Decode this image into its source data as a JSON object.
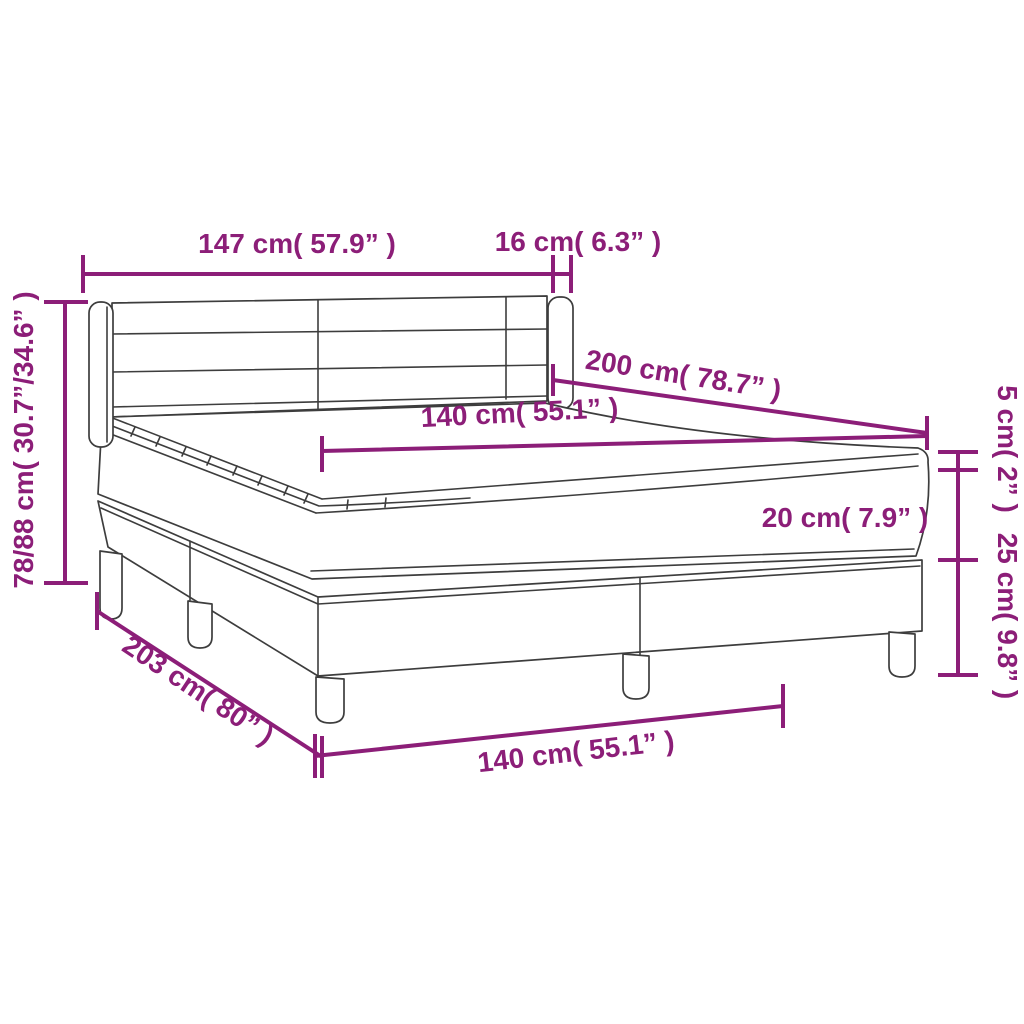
{
  "meta": {
    "description": "Dimension diagram of a box spring bed with headboard, mattress topper, mattress and two-piece slatted base with legs"
  },
  "colors": {
    "background": "#ffffff",
    "dimension": "#8c1e78",
    "outline": "#3d3d3d"
  },
  "dimensions": {
    "headboard_width": {
      "label": "147 cm( 57.9” )",
      "cm": "147",
      "inches": "57.9"
    },
    "headboard_depth": {
      "label": "16 cm( 6.3” )",
      "cm": "16",
      "inches": "6.3"
    },
    "overall_height": {
      "label": "78/88 cm( 30.7”/34.6” )",
      "cm": "78/88",
      "inches": "30.7/34.6"
    },
    "bed_length": {
      "label": "200 cm( 78.7” )",
      "cm": "200",
      "inches": "78.7"
    },
    "mattress_width": {
      "label": "140 cm( 55.1” )",
      "cm": "140",
      "inches": "55.1"
    },
    "topper_height": {
      "label": "5 cm( 2” )",
      "cm": "5",
      "inches": "2"
    },
    "mattress_height": {
      "label": "20 cm( 7.9” )",
      "cm": "20",
      "inches": "7.9"
    },
    "base_height": {
      "label": "25 cm( 9.8” )",
      "cm": "25",
      "inches": "9.8"
    },
    "base_length": {
      "label": "203 cm( 80” )",
      "cm": "203",
      "inches": "80"
    },
    "base_width": {
      "label": "140 cm( 55.1” )",
      "cm": "140",
      "inches": "55.1"
    }
  }
}
